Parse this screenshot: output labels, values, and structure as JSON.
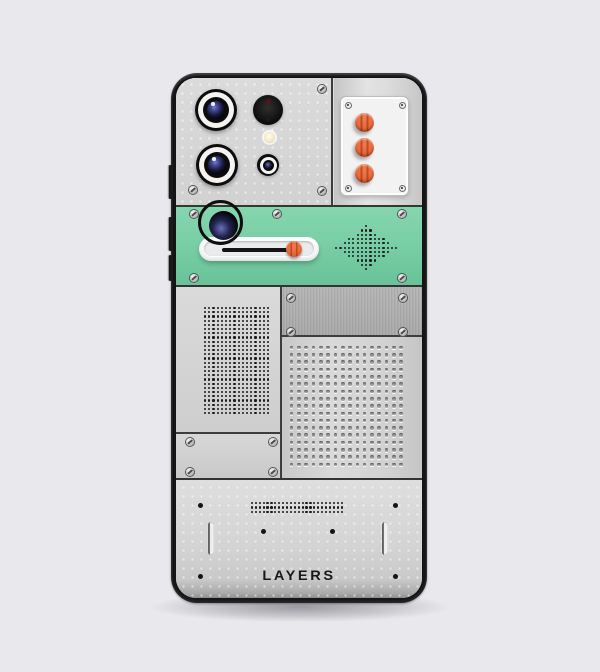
{
  "brand": {
    "wordmark": "LAYERS"
  },
  "colors": {
    "background": "#E9E8EC",
    "panel_gray": "#D6D5D6",
    "frame_black": "#141414",
    "accent_green": "#79CFA6",
    "accent_orange": "#E8683B",
    "dot_black": "#1B1B1B"
  },
  "controls": {
    "knob_count": 3,
    "slider": {
      "value_percent": 95
    }
  },
  "grids": {
    "speaker_diamond": {
      "cols": 15,
      "rows": 11,
      "cell": 4.3,
      "dot": 2.2,
      "shape": "diamond",
      "style": "black"
    },
    "left_speaker": {
      "cols": 16,
      "rows": 26,
      "cell": 4.2,
      "dot": 2.1,
      "shape": "rect",
      "style": "black"
    },
    "perforated": {
      "cols": 16,
      "rows": 17,
      "cell": 7.3,
      "dot": 3.6,
      "shape": "rect",
      "style": "hole"
    },
    "bottom_matrix": {
      "cols": 24,
      "rows": 3,
      "cellX": 3.9,
      "cellY": 4.3,
      "dot": 2.2,
      "shape": "rect",
      "style": "black"
    }
  }
}
